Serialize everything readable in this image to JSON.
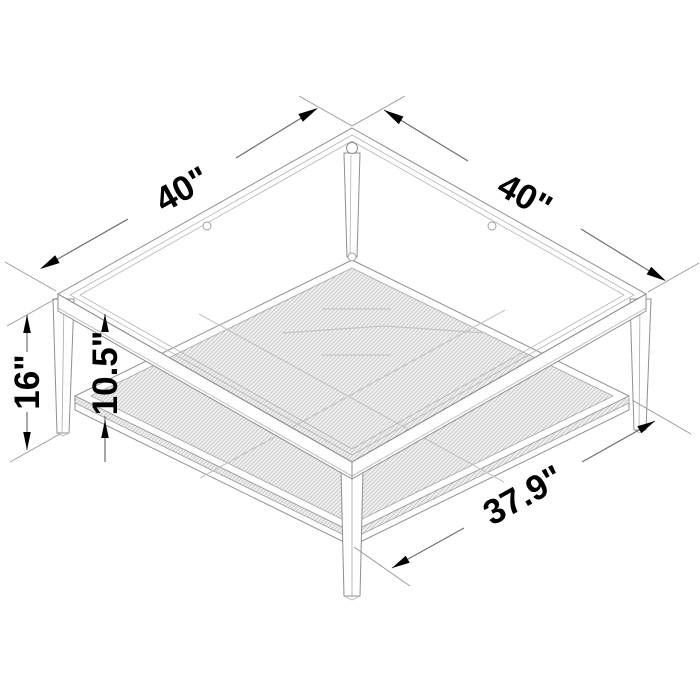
{
  "diagram": {
    "kind": "product-dimension-diagram",
    "subject": "square coffee table with glass top, metal frame and mesh lower shelf (isometric line drawing)",
    "background_color": "#ffffff",
    "drawing_line_color": "#8f8f8f",
    "dimension_line_color": "#6e6e6e",
    "dimension_text_color": "#000000",
    "labels": {
      "top_left_edge": "40\"",
      "top_right_edge": "40\"",
      "overall_height": "16\"",
      "shelf_clearance": "10.5\"",
      "shelf_front_edge": "37.9\""
    }
  }
}
